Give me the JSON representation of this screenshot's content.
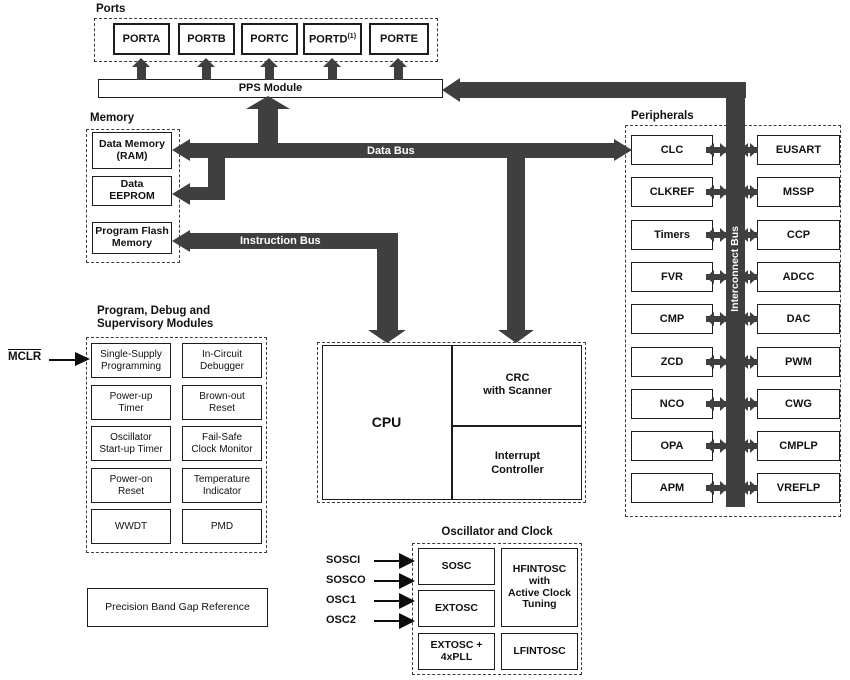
{
  "colors": {
    "bus": "#3f3f3f",
    "ink": "#1d1d1d",
    "background": "#ffffff"
  },
  "ports": {
    "section_label": "Ports",
    "items": [
      "PORTA",
      "PORTB",
      "PORTC",
      "PORTD",
      "PORTE"
    ],
    "portd_note": "(1)",
    "pps_label": "PPS Module"
  },
  "memory": {
    "section_label": "Memory",
    "ram": [
      "Data Memory",
      "(RAM)"
    ],
    "eeprom": [
      "Data",
      "EEPROM"
    ],
    "flash": [
      "Program Flash",
      "Memory"
    ]
  },
  "buses": {
    "data_bus": "Data Bus",
    "instruction_bus": "Instruction Bus",
    "interconnect_bus": "Interconnect Bus"
  },
  "peripherals": {
    "section_label": "Peripherals",
    "left": [
      "CLC",
      "CLKREF",
      "Timers",
      "FVR",
      "CMP",
      "ZCD",
      "NCO",
      "OPA",
      "APM"
    ],
    "right": [
      "EUSART",
      "MSSP",
      "CCP",
      "ADCC",
      "DAC",
      "PWM",
      "CWG",
      "CMPLP",
      "VREFLP"
    ]
  },
  "supervisory": {
    "title_line1": "Program, Debug and",
    "title_line2": "Supervisory Modules",
    "mclr": "MCLR",
    "left": [
      [
        "Single-Supply",
        "Programming"
      ],
      [
        "Power-up",
        "Timer"
      ],
      [
        "Oscillator",
        "Start-up Timer"
      ],
      [
        "Power-on",
        "Reset"
      ],
      [
        "WWDT"
      ]
    ],
    "right": [
      [
        "In-Circuit",
        "Debugger"
      ],
      [
        "Brown-out",
        "Reset"
      ],
      [
        "Fail-Safe",
        "Clock Monitor"
      ],
      [
        "Temperature",
        "Indicator"
      ],
      [
        "PMD"
      ]
    ]
  },
  "cpu": {
    "label": "CPU",
    "crc": [
      "CRC",
      "with Scanner"
    ],
    "interrupt": [
      "Interrupt",
      "Controller"
    ]
  },
  "oscillator": {
    "section_label": "Oscillator and Clock",
    "sosc": "SOSC",
    "extosc": "EXTOSC",
    "extpll": [
      "EXTOSC +",
      "4xPLL"
    ],
    "hfintosc": [
      "HFINTOSC",
      "with",
      "Active Clock",
      "Tuning"
    ],
    "lfintosc": "LFINTOSC",
    "pins": [
      "SOSCI",
      "SOSCO",
      "OSC1",
      "OSC2"
    ]
  },
  "bandgap": {
    "label": "Precision Band Gap Reference"
  }
}
